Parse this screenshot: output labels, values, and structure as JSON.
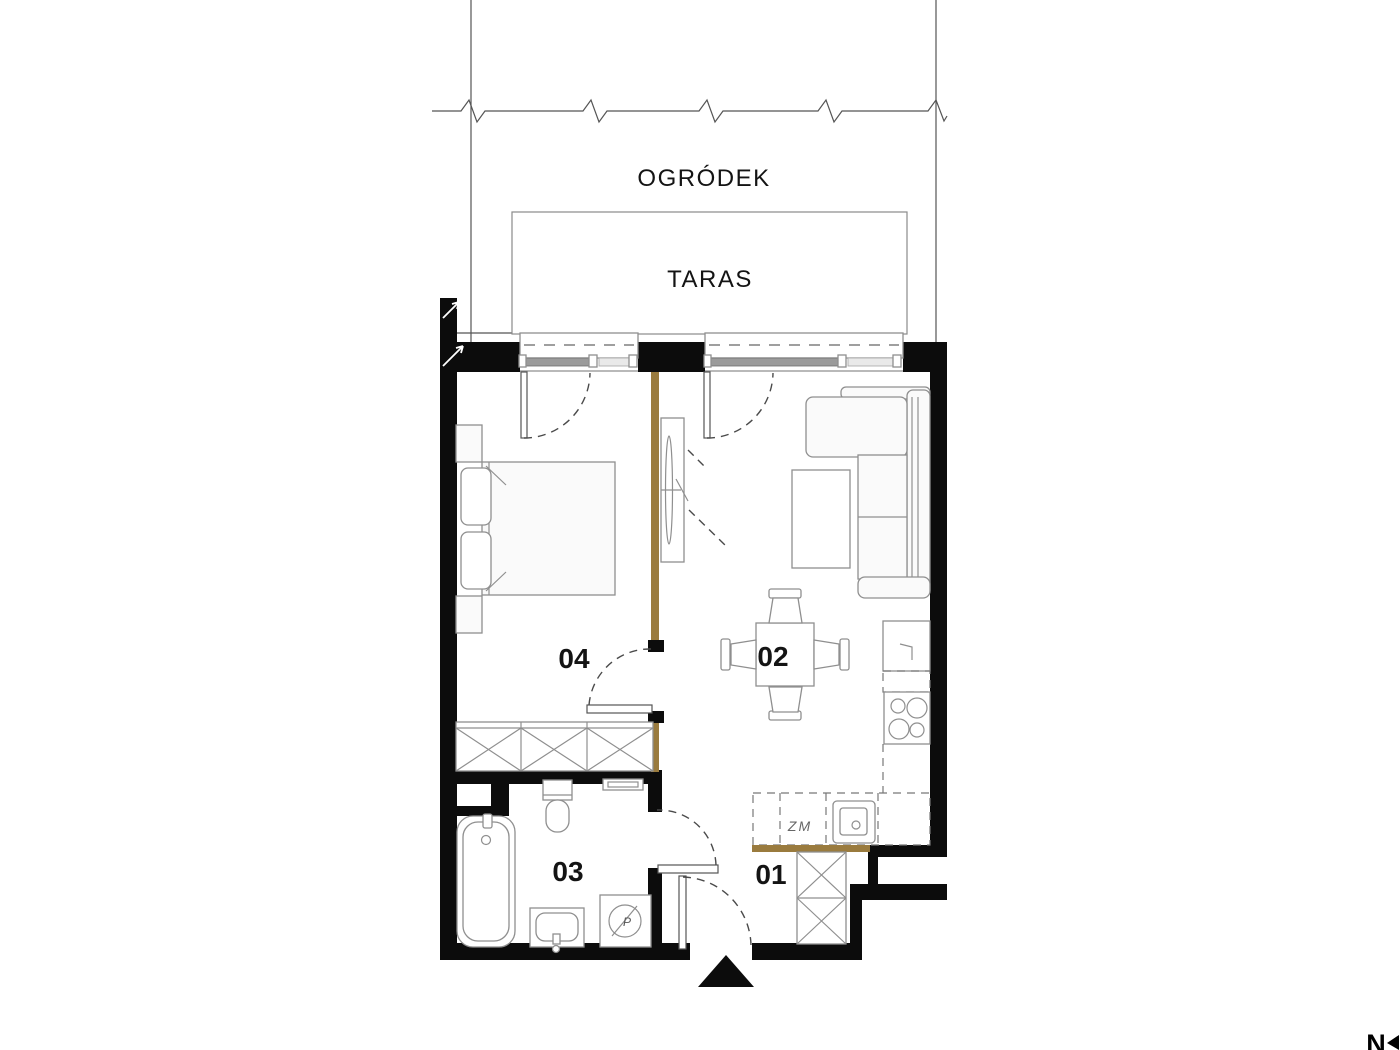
{
  "site": {
    "garden_label": "OGRÓDEK",
    "terrace_label": "TARAS"
  },
  "rooms": {
    "hall": {
      "label": "01"
    },
    "living": {
      "label": "02"
    },
    "bathroom": {
      "label": "03"
    },
    "bedroom": {
      "label": "04"
    }
  },
  "kitchen": {
    "dishwasher_label": "ZM"
  },
  "appliances": {
    "washing_machine_label": "P"
  },
  "compass": {
    "north_label": "N"
  },
  "colors": {
    "wall": "#0c0c0c",
    "partition_accent": "#9a7b3e",
    "counter_accent": "#9a7b3e",
    "furniture_line": "#8f8f8f",
    "label_text": "#141414"
  }
}
